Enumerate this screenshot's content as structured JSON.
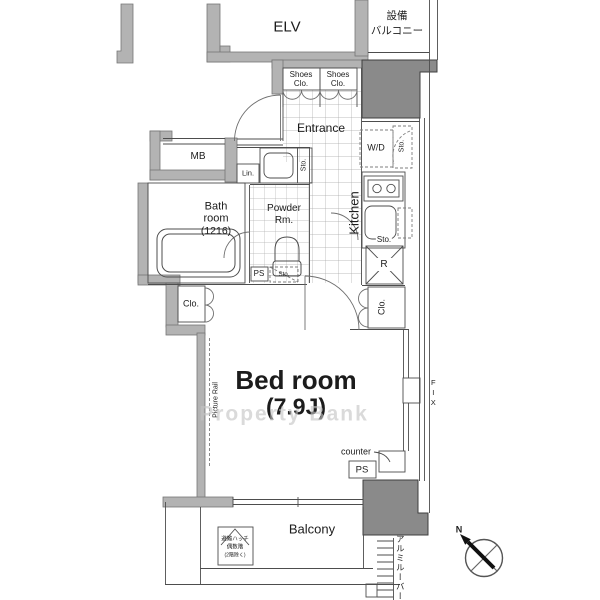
{
  "watermark": "Property Bank",
  "common": {
    "elevator": "ELV",
    "equipment_balcony_line1": "設備",
    "equipment_balcony_line2": "バルコニー"
  },
  "entrance": {
    "label": "Entrance",
    "shoes_line1": "Shoes",
    "shoes_line2": "Clo.",
    "meter_box": "MB"
  },
  "sanitary": {
    "bath_line1": "Bath",
    "bath_line2": "room",
    "bath_line3": "(1216)",
    "powder_line1": "Powder",
    "powder_line2": "Rm.",
    "linen": "Lin.",
    "storage": "Sto.",
    "washer_dryer": "W/D",
    "pipe_space": "PS"
  },
  "kitchen": {
    "label": "Kitchen",
    "storage": "Sto.",
    "refrigerator": "R"
  },
  "bedroom": {
    "name": "Bed room",
    "size": "(7.9J)",
    "closet": "Clo.",
    "picture_rail": "Picture Rail",
    "counter": "counter",
    "fix_window": "FIX",
    "pipe_space": "PS"
  },
  "balcony": {
    "label": "Balcony",
    "hatch_line1": "避難ハッチ",
    "hatch_line2": "偶数階",
    "hatch_line3": "(2階除く)",
    "louver": "アルミルーバー"
  },
  "compass": {
    "north": "N"
  },
  "colors": {
    "wall": "#b3b3b3",
    "pillar": "#8a8a8a",
    "line": "#4d4d4d",
    "tile_line": "#a6a6a6",
    "watermark": "#c4c4c4"
  }
}
